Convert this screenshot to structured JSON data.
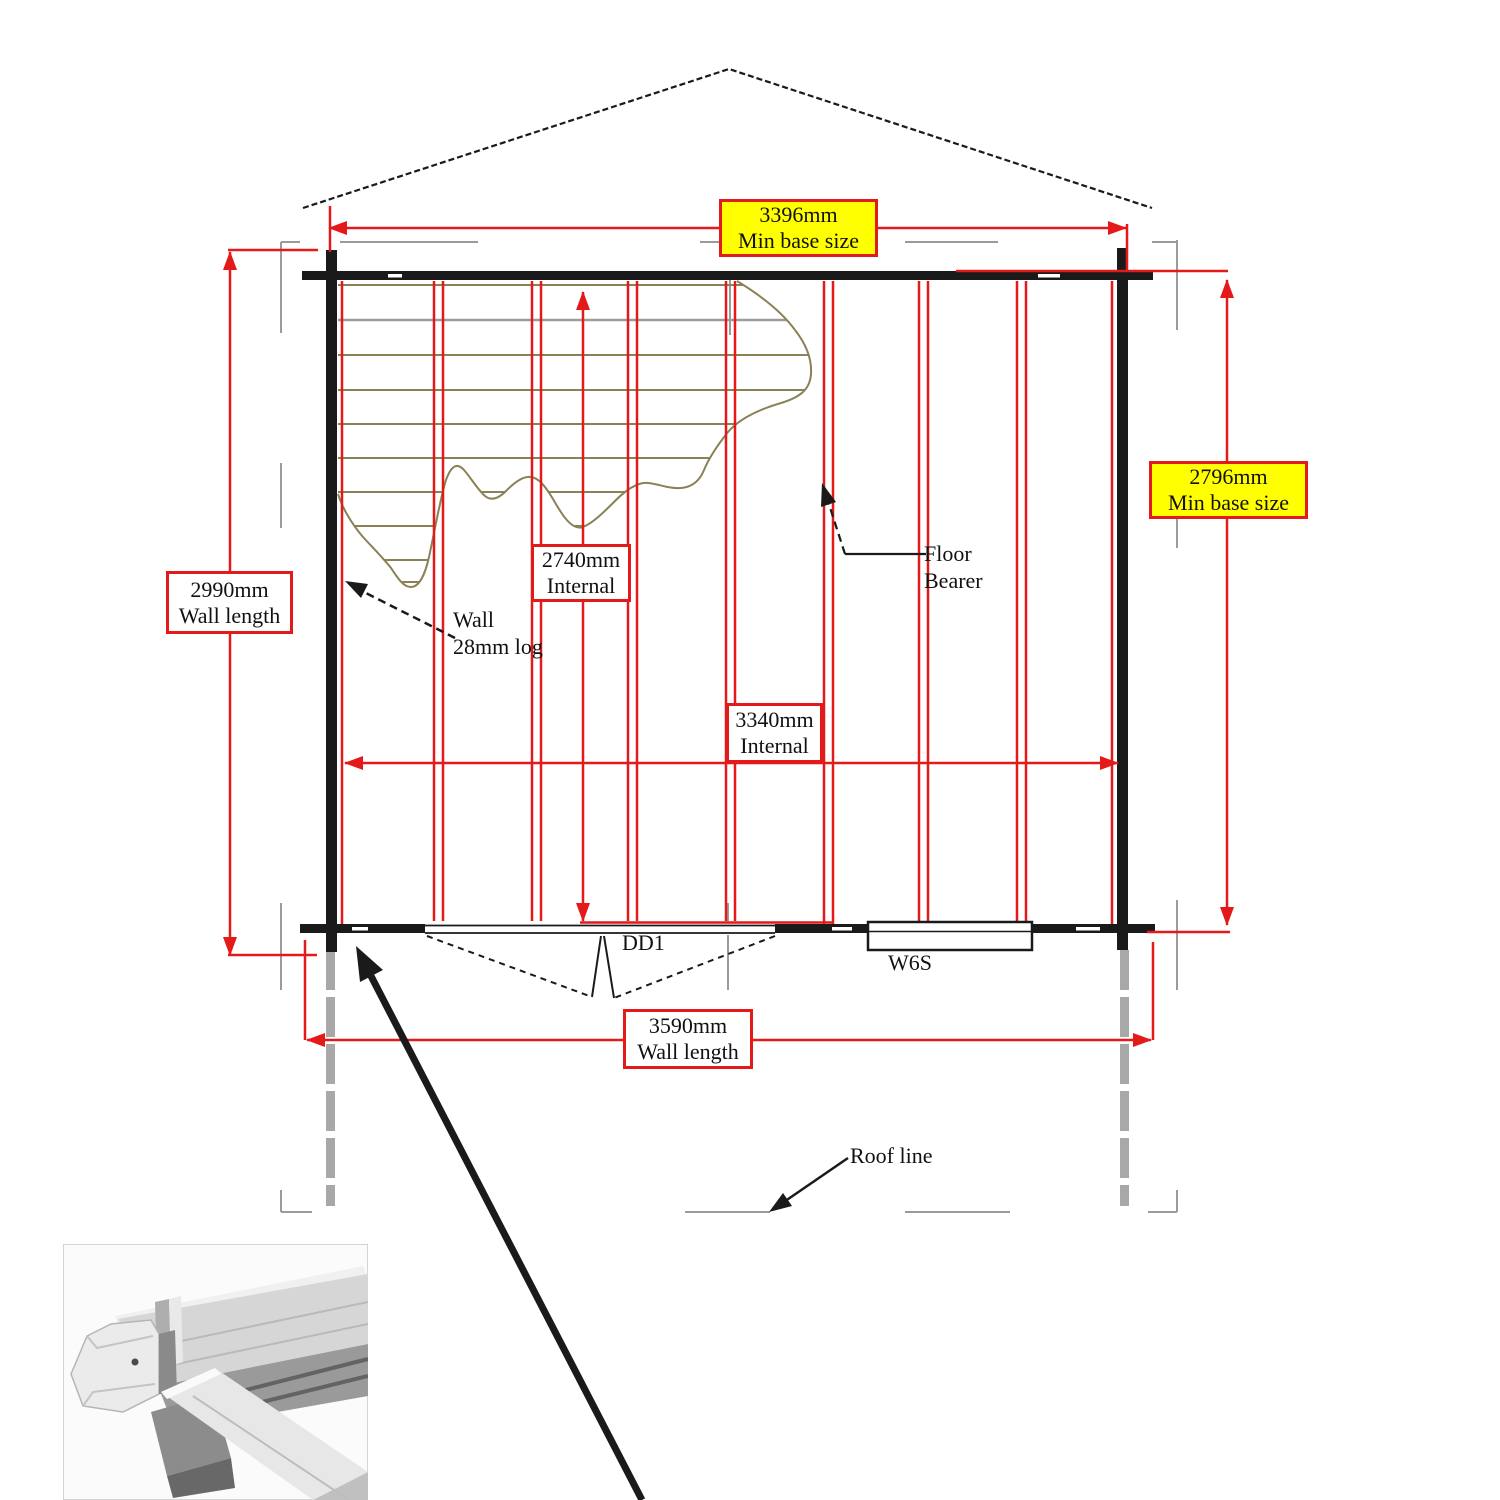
{
  "diagram": {
    "type": "log-cabin floor plan",
    "dimensions": {
      "base_width": {
        "value": "3396mm",
        "caption": "Min base size"
      },
      "base_depth": {
        "value": "2796mm",
        "caption": "Min base size"
      },
      "wall_side": {
        "value": "2990mm",
        "caption": "Wall length"
      },
      "wall_front": {
        "value": "3590mm",
        "caption": "Wall length"
      },
      "internal_depth": {
        "value": "2740mm",
        "caption": "Internal"
      },
      "internal_width": {
        "value": "3340mm",
        "caption": "Internal"
      }
    },
    "annotations": {
      "wall_note_line1": "Wall",
      "wall_note_line2": "28mm log",
      "floor_bearer_line1": "Floor",
      "floor_bearer_line2": "Bearer",
      "door_label": "DD1",
      "window_label": "W6S",
      "roof_line_label": "Roof line"
    },
    "colors": {
      "dimension_red": "#e41a1a",
      "highlight_yellow": "#ffff00",
      "wall_black": "#1a1a1a",
      "hatch_olive": "#8b8157",
      "roof_dash_gray": "#9b9b9b"
    }
  }
}
